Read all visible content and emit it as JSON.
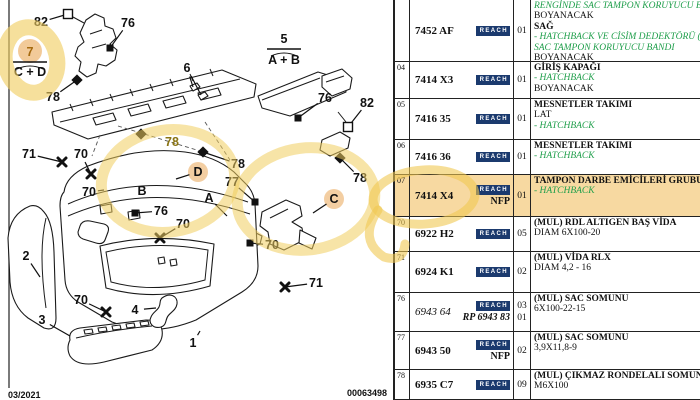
{
  "diagram": {
    "footer_left": "03/2021",
    "footer_code": "00063498",
    "group_callouts": [
      {
        "top": "7",
        "bottom": "C + D",
        "x": 30,
        "ty": 56,
        "ly": 62,
        "by": 76,
        "circle": true,
        "brace": true
      },
      {
        "top": "5",
        "bottom": "A + B",
        "x": 284,
        "ty": 43,
        "ly": 49,
        "by": 64,
        "brace": true
      }
    ],
    "callouts": [
      {
        "label": "82",
        "x": 41,
        "y": 26,
        "marker": "open-square",
        "mx": 68,
        "my": 14
      },
      {
        "label": "76",
        "x": 128,
        "y": 27,
        "marker": "filled-square",
        "mx": 110,
        "my": 48
      },
      {
        "label": "78",
        "x": 53,
        "y": 101,
        "marker": "filled-diamond",
        "mx": 77,
        "my": 80
      },
      {
        "label": "6",
        "x": 187,
        "y": 72,
        "marker": "none",
        "mx": 193,
        "my": 87,
        "mx2": 201,
        "my2": 95
      },
      {
        "label": "76",
        "x": 325,
        "y": 102,
        "marker": "filled-square",
        "mx": 298,
        "my": 118
      },
      {
        "label": "82",
        "x": 367,
        "y": 107,
        "marker": "open-square",
        "mx": 348,
        "my": 127
      },
      {
        "label": "78",
        "x": 360,
        "y": 182,
        "marker": "filled-diamond",
        "mx": 340,
        "my": 158
      },
      {
        "label": "71",
        "x": 29,
        "y": 158,
        "marker": "cross",
        "mx": 62,
        "my": 162
      },
      {
        "label": "70",
        "x": 81,
        "y": 158,
        "marker": "cross",
        "mx": 91,
        "my": 174
      },
      {
        "label": "70",
        "x": 89,
        "y": 196,
        "marker": "none",
        "mx": 104,
        "my": 190
      },
      {
        "label": "78",
        "x": 172,
        "y": 146,
        "marker": "none",
        "olive": true
      },
      {
        "label": "B",
        "x": 142,
        "y": 195,
        "marker": "none"
      },
      {
        "label": "D",
        "x": 198,
        "y": 176,
        "marker": "none",
        "circled": true,
        "mx": 176,
        "my": 179
      },
      {
        "label": "76",
        "x": 161,
        "y": 215,
        "marker": "filled-square",
        "mx": 135,
        "my": 213
      },
      {
        "label": "70",
        "x": 183,
        "y": 228,
        "marker": "cross",
        "mx": 160,
        "my": 238
      },
      {
        "label": "77",
        "x": 232,
        "y": 186,
        "marker": "filled-square",
        "mx": 255,
        "my": 202
      },
      {
        "label": "78",
        "x": 238,
        "y": 168,
        "marker": "filled-diamond",
        "mx": 203,
        "my": 152
      },
      {
        "label": "A",
        "x": 209,
        "y": 202,
        "marker": "none",
        "mx": 227,
        "my": 216
      },
      {
        "label": "C",
        "x": 334,
        "y": 203,
        "marker": "none",
        "circled": true,
        "mx": 313,
        "my": 213
      },
      {
        "label": "70",
        "x": 272,
        "y": 249,
        "marker": "filled-square",
        "mx": 250,
        "my": 243
      },
      {
        "label": "71",
        "x": 316,
        "y": 287,
        "marker": "cross",
        "mx": 285,
        "my": 287
      },
      {
        "label": "70",
        "x": 81,
        "y": 304,
        "marker": "cross",
        "mx": 106,
        "my": 312
      },
      {
        "label": "4",
        "x": 135,
        "y": 314,
        "marker": "none",
        "mx": 156,
        "my": 308
      },
      {
        "label": "3",
        "x": 42,
        "y": 324,
        "marker": "none",
        "mx": 70,
        "my": 336
      },
      {
        "label": "2",
        "x": 26,
        "y": 260,
        "marker": "none",
        "mx": 40,
        "my": 277
      },
      {
        "label": "1",
        "x": 193,
        "y": 347,
        "marker": "none",
        "mx": 200,
        "my": 331
      }
    ]
  },
  "table": {
    "reach_label": "REACH",
    "rows": [
      {
        "num": "",
        "part": "7452 AF",
        "reach": true,
        "qty": [
          "01"
        ],
        "h": 62,
        "desc": [
          {
            "t": "RENGİNDE SAC TAMPON KORUYUCU BANDI",
            "s": "g"
          },
          {
            "t": "BOYANACAK",
            "s": "n"
          },
          {
            "t": "SAĞ",
            "s": "b"
          },
          {
            "t": "- HATCHBACK VE CİSİM DEDEKTÖRÜ (M",
            "s": "g"
          },
          {
            "t": "SAC TAMPON KORUYUCU BANDI",
            "s": "g"
          },
          {
            "t": "BOYANACAK",
            "s": "n"
          }
        ]
      },
      {
        "num": "04",
        "part": "7414 X3",
        "reach": true,
        "qty": [
          "01"
        ],
        "h": 37,
        "desc": [
          {
            "t": "GİRİŞ KAPAĞI",
            "s": "b"
          },
          {
            "t": "- HATCHBACK",
            "s": "g"
          },
          {
            "t": "BOYANACAK",
            "s": "n"
          }
        ]
      },
      {
        "num": "05",
        "part": "7416 35",
        "reach": true,
        "qty": [
          "01"
        ],
        "h": 41,
        "desc": [
          {
            "t": "MESNETLER TAKIMI",
            "s": "b"
          },
          {
            "t": "LAT",
            "s": "n"
          },
          {
            "t": "- HATCHBACK",
            "s": "g"
          }
        ]
      },
      {
        "num": "06",
        "part": "7416 36",
        "reach": true,
        "qty": [
          "01"
        ],
        "h": 35,
        "desc": [
          {
            "t": "MESNETLER TAKIMI",
            "s": "b"
          },
          {
            "t": "- HATCHBACK",
            "s": "g"
          }
        ]
      },
      {
        "num": "07",
        "part": "7414 X4",
        "reach": true,
        "nfp": "NFP",
        "qty": [
          "01"
        ],
        "h": 42,
        "highlight": true,
        "desc": [
          {
            "t": "TAMPON DARBE EMİCİLERİ GRUBU",
            "s": "b"
          },
          {
            "t": "- HATCHBACK",
            "s": "g"
          }
        ]
      },
      {
        "num": "70",
        "part": "6922 H2",
        "reach": true,
        "qty": [
          "05"
        ],
        "h": 35,
        "desc": [
          {
            "t": "(MUL) RDL ALTIGEN BAŞ VİDA",
            "s": "b"
          },
          {
            "t": "DIAM 6X100-20",
            "s": "n"
          }
        ]
      },
      {
        "num": "71",
        "part": "6924 K1",
        "reach": true,
        "qty": [
          "02"
        ],
        "h": 41,
        "desc": [
          {
            "t": "(MUL) VİDA RLX",
            "s": "b"
          },
          {
            "t": "DIAM 4,2 - 16",
            "s": "n"
          }
        ]
      },
      {
        "num": "76",
        "part": "6943 64",
        "part_italic": true,
        "reach": true,
        "sub": "RP 6943 83",
        "qty": [
          "03",
          "01"
        ],
        "h": 39,
        "desc": [
          {
            "t": "(MUL) SAC SOMUNU",
            "s": "b"
          },
          {
            "t": "6X100-22-15",
            "s": "n"
          }
        ]
      },
      {
        "num": "77",
        "part": "6943 50",
        "reach": true,
        "nfp": "NFP",
        "qty": [
          "02"
        ],
        "h": 38,
        "desc": [
          {
            "t": "(MUL) SAC SOMUNU",
            "s": "b"
          },
          {
            "t": "3,9X11,8-9",
            "s": "n"
          }
        ]
      },
      {
        "num": "78",
        "part": "6935 C7",
        "reach": true,
        "qty": [
          "09"
        ],
        "h": 30,
        "desc": [
          {
            "t": "(MUL) ÇIKMAZ RONDELALI SOMUN",
            "s": "b"
          },
          {
            "t": "M6X100",
            "s": "n"
          }
        ]
      }
    ]
  },
  "colors": {
    "green_text": "#1e9e4a",
    "reach_navy": "#1b3a6e",
    "row_highlight": "#f7d9a1",
    "highlighter_yellow": "#f1cd5f",
    "highlighter_orange": "#e89e46"
  }
}
